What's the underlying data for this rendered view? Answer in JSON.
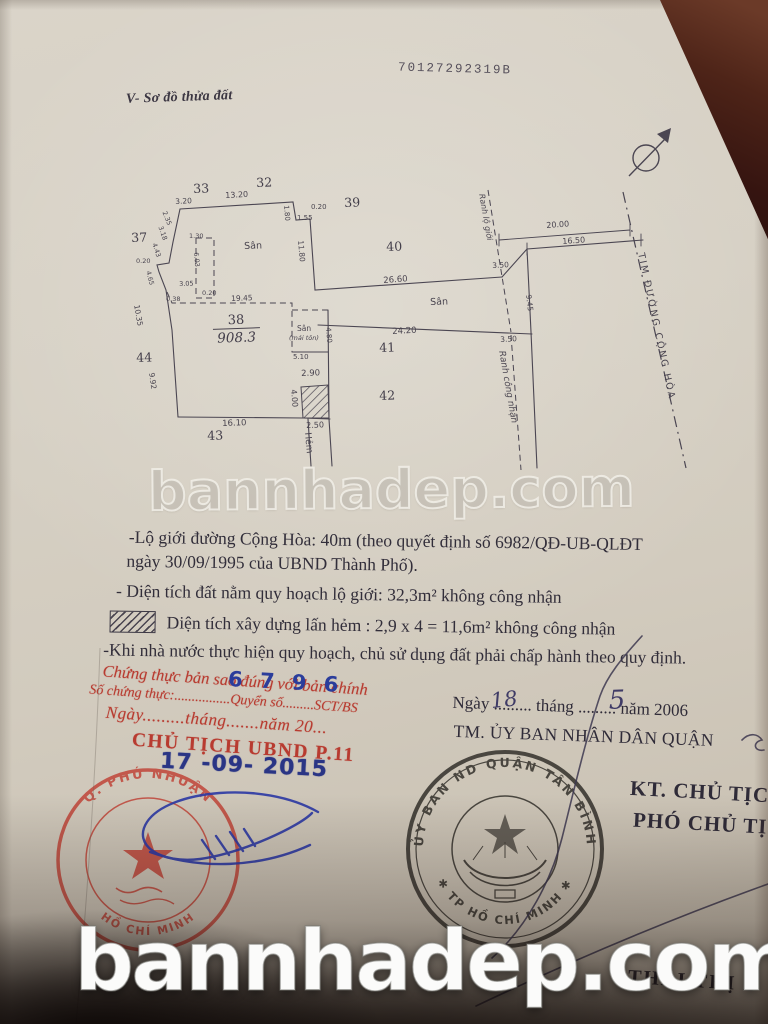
{
  "colors": {
    "paper": "#d6d0c4",
    "ink": "#3f3a45",
    "stamp_red": "#b83b30",
    "ink_blue": "#2c39a5",
    "background_dark": "#23120d"
  },
  "photo": {
    "watermark": "bannhadep.com"
  },
  "document": {
    "serial": "70127292319B",
    "section_title": "V- Sơ đồ thửa đất",
    "notes": [
      "-Lộ giới đường Cộng Hòa: 40m (theo quyết định số 6982/QĐ-UB-QLĐT",
      "ngày 30/09/1995 của UBND Thành Phố).",
      "- Diện tích đất nằm quy hoạch lộ giới: 32,3m² không công nhận",
      "Diện tích xây dựng lấn hẻm : 2,9 x 4 = 11,6m² không công nhận",
      "-Khi nhà nước thực hiện quy hoạch, chủ sử dụng đất phải chấp hành theo quy định."
    ]
  },
  "diagram": {
    "lot38": {
      "num": "38",
      "area": "908.3"
    },
    "lots": [
      {
        "id": "33",
        "x": 193,
        "y": 181
      },
      {
        "id": "32",
        "x": 256,
        "y": 175
      },
      {
        "id": "39",
        "x": 344,
        "y": 195
      },
      {
        "id": "37",
        "x": 131,
        "y": 230
      },
      {
        "id": "40",
        "x": 386,
        "y": 239
      },
      {
        "id": "44",
        "x": 136,
        "y": 350
      },
      {
        "id": "41",
        "x": 379,
        "y": 340
      },
      {
        "id": "42",
        "x": 379,
        "y": 388
      },
      {
        "id": "43",
        "x": 207,
        "y": 428
      }
    ],
    "labels": [
      {
        "t": "3.20",
        "x": 175,
        "y": 197,
        "r": -3,
        "s": 7.5
      },
      {
        "t": "13.20",
        "x": 225,
        "y": 191,
        "r": -3,
        "s": 8
      },
      {
        "t": "0.20",
        "x": 311,
        "y": 203,
        "r": 0,
        "s": 7
      },
      {
        "t": "1.55",
        "x": 297,
        "y": 214,
        "r": 0,
        "s": 7
      },
      {
        "t": "1.80",
        "x": 290,
        "y": 205,
        "r": 85,
        "s": 7
      },
      {
        "t": "11.80",
        "x": 305,
        "y": 240,
        "r": 85,
        "s": 7.5
      },
      {
        "t": "26.60",
        "x": 383,
        "y": 276,
        "r": -4,
        "s": 8.5
      },
      {
        "t": "3.50",
        "x": 492,
        "y": 261,
        "r": -3,
        "s": 7.5
      },
      {
        "t": "20.00",
        "x": 546,
        "y": 221,
        "r": -4,
        "s": 8
      },
      {
        "t": "16.50",
        "x": 562,
        "y": 237,
        "r": -4,
        "s": 8
      },
      {
        "t": "9.45",
        "x": 533,
        "y": 294,
        "r": 83,
        "s": 7.5
      },
      {
        "t": "Sân",
        "x": 244,
        "y": 241,
        "r": -2,
        "s": 9.5
      },
      {
        "t": "Sân",
        "x": 430,
        "y": 297,
        "r": -2,
        "s": 9.5
      },
      {
        "t": "24.20",
        "x": 392,
        "y": 327,
        "r": -3,
        "s": 8.5
      },
      {
        "t": "3.50",
        "x": 500,
        "y": 335,
        "r": -3,
        "s": 7.5
      },
      {
        "t": "19.45",
        "x": 231,
        "y": 294,
        "r": -2,
        "s": 7.5
      },
      {
        "t": "Sân",
        "x": 297,
        "y": 324,
        "r": 0,
        "s": 7.5
      },
      {
        "t": "(mái tôn)",
        "x": 289,
        "y": 334,
        "r": 0,
        "s": 6.5,
        "i": true
      },
      {
        "t": "5.10",
        "x": 293,
        "y": 353,
        "r": 0,
        "s": 7
      },
      {
        "t": "4.80",
        "x": 332,
        "y": 327,
        "r": 85,
        "s": 7
      },
      {
        "t": "2.90",
        "x": 301,
        "y": 369,
        "r": -2,
        "s": 8.5
      },
      {
        "t": "4.00",
        "x": 298,
        "y": 389,
        "r": 85,
        "s": 8
      },
      {
        "t": "16.10",
        "x": 222,
        "y": 419,
        "r": -2,
        "s": 8.5
      },
      {
        "t": "2.50",
        "x": 306,
        "y": 421,
        "r": -2,
        "s": 8
      },
      {
        "t": "Hẻm",
        "x": 312,
        "y": 432,
        "r": 85,
        "s": 9
      },
      {
        "t": "10.35",
        "x": 141,
        "y": 304,
        "r": 80,
        "s": 7.5
      },
      {
        "t": "9.92",
        "x": 156,
        "y": 372,
        "r": 82,
        "s": 7.5
      },
      {
        "t": "4.65",
        "x": 152,
        "y": 270,
        "r": 75,
        "s": 6.5
      },
      {
        "t": "0.20",
        "x": 136,
        "y": 257,
        "r": 0,
        "s": 6.5
      },
      {
        "t": "4.43",
        "x": 158,
        "y": 242,
        "r": 72,
        "s": 6.5
      },
      {
        "t": "3.18",
        "x": 164,
        "y": 225,
        "r": 70,
        "s": 6.5
      },
      {
        "t": "2.35",
        "x": 168,
        "y": 210,
        "r": 68,
        "s": 6.5
      },
      {
        "t": "3.05",
        "x": 179,
        "y": 280,
        "r": -2,
        "s": 6.5
      },
      {
        "t": "0.20",
        "x": 202,
        "y": 289,
        "r": 0,
        "s": 6.5
      },
      {
        "t": "6.03",
        "x": 200,
        "y": 252,
        "r": 85,
        "s": 6.5
      },
      {
        "t": "1.30",
        "x": 189,
        "y": 232,
        "r": 0,
        "s": 6.5
      },
      {
        "t": "0.38",
        "x": 166,
        "y": 295,
        "r": 0,
        "s": 6.5
      },
      {
        "t": "Ranh lộ giới",
        "x": 486,
        "y": 193,
        "r": 80,
        "s": 8,
        "i": true
      },
      {
        "t": "Ranh công nhận",
        "x": 506,
        "y": 350,
        "r": 80,
        "s": 9,
        "i": true
      },
      {
        "t": "TIM ĐƯỜNG CỘNG HÒA",
        "x": 646,
        "y": 252,
        "r": 78,
        "s": 9.5,
        "ls": 2
      }
    ]
  },
  "certification": {
    "line1": "Chứng thực bản sao đúng với bản chính",
    "line2": "Số chứng thực:................Quyển số.........SCT/BS",
    "line3": "Ngày.........tháng.......năm 20...",
    "line4": "CHỦ TỊCH UBND P.11",
    "number": "6 7 9 6",
    "date_stamp": "17 -09- 2015"
  },
  "approval": {
    "date": {
      "w1": "Ngày",
      "dots1": ".........",
      "day": "18",
      "w2": "tháng",
      "dots2": ".........",
      "month": "5",
      "w3": "năm 2006"
    },
    "tm_line": "TM. ỦY BAN NHÂN DÂN QUẬN",
    "kt_line": "KT. CHỦ TỊCH",
    "pho_line": "PHÓ CHỦ TỊCH",
    "signer_name": "THÁI THỊ D"
  },
  "stamps": {
    "red": {
      "arc_top": "Q. PHÚ NHUẬN",
      "arc_bottom": "HỒ CHÍ MINH"
    },
    "black": {
      "arc_top": "ỦY BAN ND QUẬN TÂN BÌNH",
      "arc_bottom": "✱ TP HỒ CHÍ MINH ✱"
    }
  }
}
